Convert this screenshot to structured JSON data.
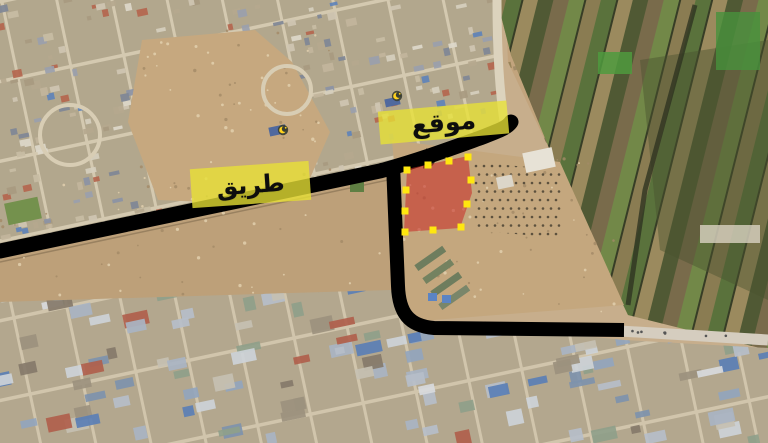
{
  "annotations": {
    "site_label": {
      "text": "موقع",
      "highlight": "#e8e135",
      "text_color": "#0d0d0d"
    },
    "road_label": {
      "text": "طريق",
      "highlight": "#e8e135",
      "text_color": "#0d0d0d"
    },
    "site_area": {
      "fill": "#c82f28",
      "fill_opacity": 0.58,
      "handle_color": "#ffe70f",
      "points": "407,169 468,156 472,193 460,228 404,232",
      "handles": [
        [
          407,
          170
        ],
        [
          428,
          165
        ],
        [
          449,
          161
        ],
        [
          468,
          157
        ],
        [
          471,
          180
        ],
        [
          467,
          204
        ],
        [
          461,
          227
        ],
        [
          433,
          230
        ],
        [
          405,
          232
        ],
        [
          405,
          211
        ],
        [
          406,
          190
        ]
      ]
    },
    "roads": {
      "color": "#000000",
      "main_path": "M 0 251 L 380 171 C 420 160 455 147 480 138 C 498 131 507 128 511 122",
      "main_width": 15,
      "branch_path": "M 393 164 L 398 286 C 399 313 409 326 434 328 L 624 330",
      "branch_width": 14
    },
    "poi_markers": [
      {
        "name": "mosque-marker",
        "x": 283,
        "y": 130,
        "color": "#ffd21e"
      },
      {
        "name": "mosque-marker",
        "x": 397,
        "y": 96,
        "color": "#ffd21e"
      }
    ]
  }
}
